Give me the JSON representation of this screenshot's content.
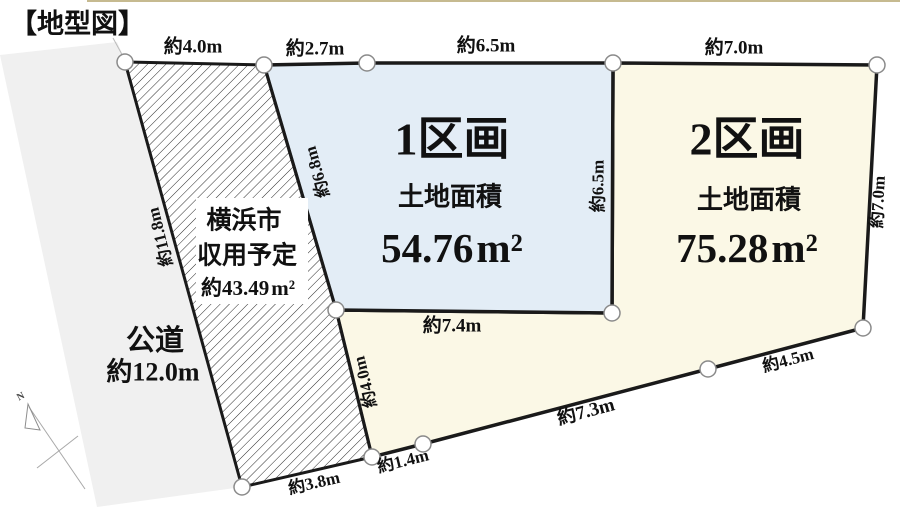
{
  "title": "【地型図】",
  "colors": {
    "parcel1_fill": "#e3edf6",
    "parcel2_fill": "#fbf8e6",
    "road_fill": "#f0f0f0",
    "parcel2_name_color": "#e60000",
    "outline": "#1a1a1a",
    "top_rule": "#c6ba90"
  },
  "parcel1": {
    "name": "1区画",
    "area_caption": "土地面積",
    "area": "54.76",
    "unit": "m²"
  },
  "parcel2": {
    "name": "2区画",
    "area_caption": "土地面積",
    "area": "75.28",
    "unit": "m²"
  },
  "expropriation": {
    "city": "横浜市",
    "plan": "収用予定",
    "area": "約43.49",
    "unit": "m²"
  },
  "road": {
    "label": "公道",
    "width": "約12.0m"
  },
  "compass": {
    "north": "N"
  },
  "dims": {
    "hatch_top": "約4.0m",
    "p1_top_left": "約2.7m",
    "p1_top": "約6.5m",
    "p2_top": "約7.0m",
    "road_side": "約11.8m",
    "hatch_right": "約6.8m",
    "p1_right": "約6.5m",
    "p2_right": "約7.0m",
    "p1_bottom": "約7.4m",
    "flag_left": "約4.0m",
    "flag_bottom": "約1.4m",
    "p2_bottom_long": "約7.3m",
    "p2_bottom_short": "約4.5m",
    "hatch_bottom": "約3.8m"
  }
}
